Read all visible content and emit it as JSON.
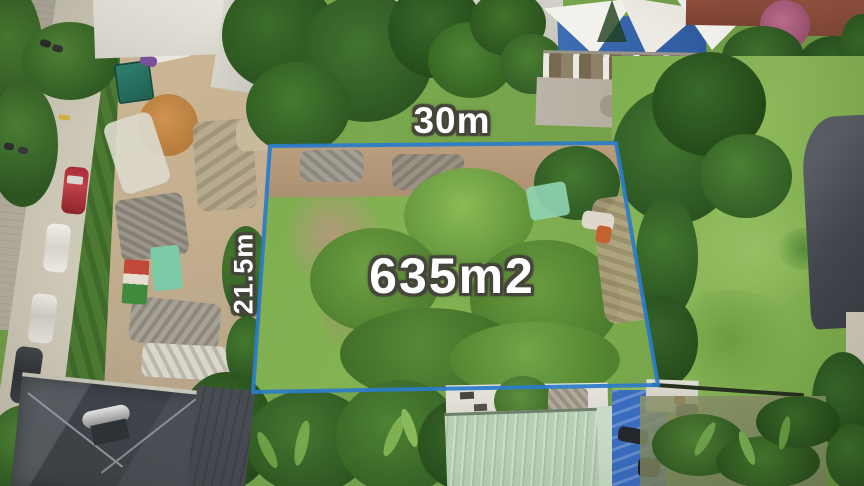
{
  "annotations": {
    "width_label": "30m",
    "height_label": "21.5m",
    "area_label": "635m2"
  },
  "boundary": {
    "points": "270,146 616,143 658,385 253,392",
    "color": "#2b7cc9",
    "stroke_width": "4"
  },
  "colors": {
    "label_text": "#ffffff",
    "label_outline": "#45453c",
    "grass": "#79a84b",
    "road": "#d5cfc0",
    "dark_roof": "#42474e",
    "green_metal_roof": "#b7cfb5",
    "blue_tarp": "#3a6cc0"
  }
}
